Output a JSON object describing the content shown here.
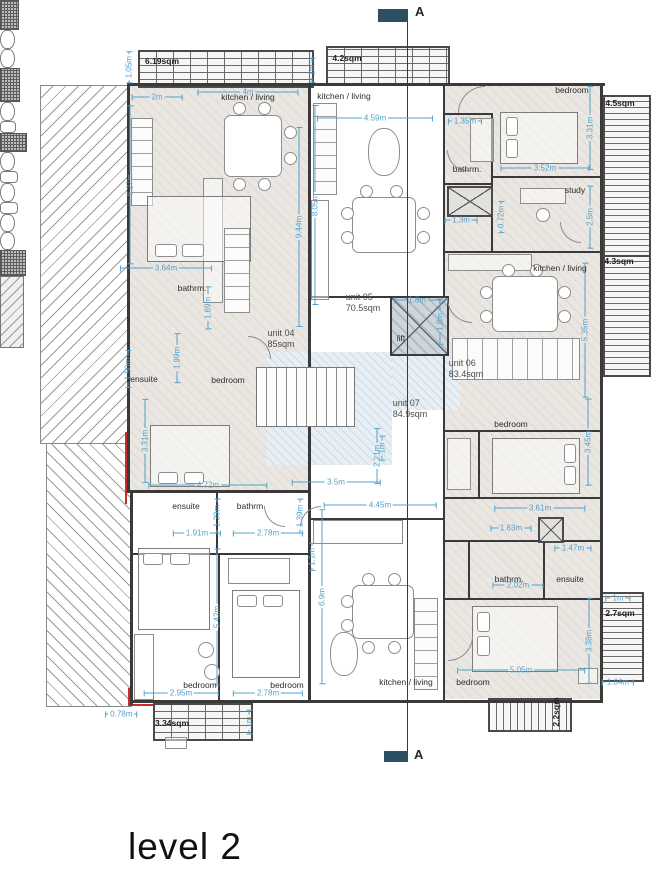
{
  "title": {
    "text": "level 2"
  },
  "section": {
    "letter_top": "A",
    "letter_bottom": "A"
  },
  "units": [
    {
      "name": "unit 04",
      "area": "85sqm",
      "x": 281,
      "y": 339
    },
    {
      "name": "unit 05",
      "area": "70.5sqm",
      "x": 363,
      "y": 303
    },
    {
      "name": "unit 06",
      "area": "83.4sqm",
      "x": 466,
      "y": 369
    },
    {
      "name": "unit 07",
      "area": "84.9sqm",
      "x": 410,
      "y": 409
    }
  ],
  "rooms": [
    {
      "t": "kitchen / living",
      "x": 248,
      "y": 97
    },
    {
      "t": "kitchen / living",
      "x": 344,
      "y": 96
    },
    {
      "t": "bathrm.",
      "x": 467,
      "y": 169
    },
    {
      "t": "bedroom",
      "x": 572,
      "y": 90
    },
    {
      "t": "study",
      "x": 575,
      "y": 190
    },
    {
      "t": "bathrm.",
      "x": 192,
      "y": 288
    },
    {
      "t": "ensuite",
      "x": 144,
      "y": 379
    },
    {
      "t": "bedroom",
      "x": 228,
      "y": 380
    },
    {
      "t": "kitchen / living",
      "x": 560,
      "y": 268
    },
    {
      "t": "bedroom",
      "x": 511,
      "y": 424
    },
    {
      "t": "lift",
      "x": 401,
      "y": 338
    },
    {
      "t": "ensuite",
      "x": 186,
      "y": 506
    },
    {
      "t": "bathrm",
      "x": 250,
      "y": 506
    },
    {
      "t": "bedroom",
      "x": 200,
      "y": 685
    },
    {
      "t": "bedroom",
      "x": 287,
      "y": 685
    },
    {
      "t": "kitchen / living",
      "x": 406,
      "y": 682
    },
    {
      "t": "bedroom",
      "x": 473,
      "y": 682
    },
    {
      "t": "bathrm.",
      "x": 509,
      "y": 579
    },
    {
      "t": "ensuite",
      "x": 570,
      "y": 579
    }
  ],
  "balcony_labels": [
    {
      "t": "6.19sqm",
      "x": 162,
      "y": 61,
      "r": 0
    },
    {
      "t": "4.2sqm",
      "x": 347,
      "y": 58,
      "r": 0
    },
    {
      "t": "4.5sqm",
      "x": 620,
      "y": 103,
      "r": 0
    },
    {
      "t": "4.3sqm",
      "x": 619,
      "y": 261,
      "r": 0
    },
    {
      "t": "2.7sqm",
      "x": 620,
      "y": 613,
      "r": 0
    },
    {
      "t": "3.34sqm",
      "x": 172,
      "y": 723,
      "r": 0
    },
    {
      "t": "2.2sqm",
      "x": 556,
      "y": 712,
      "r": 90
    }
  ],
  "dimensions": [
    {
      "t": "2m",
      "x": 157,
      "y": 97,
      "r": 0
    },
    {
      "t": "4m",
      "x": 248,
      "y": 92,
      "r": 0
    },
    {
      "t": "1m",
      "x": 312,
      "y": 70,
      "r": 90
    },
    {
      "t": "1.05m",
      "x": 129,
      "y": 70,
      "r": 90
    },
    {
      "t": "6.27m",
      "x": 130,
      "y": 185,
      "r": 90
    },
    {
      "t": "4.59m",
      "x": 375,
      "y": 118,
      "r": 0
    },
    {
      "t": "8.05m",
      "x": 315,
      "y": 205,
      "r": 90
    },
    {
      "t": "9.44m",
      "x": 299,
      "y": 227,
      "r": 90
    },
    {
      "t": "1.35m",
      "x": 465,
      "y": 121,
      "r": 0
    },
    {
      "t": "3.52m",
      "x": 545,
      "y": 168,
      "r": 0
    },
    {
      "t": "3.31m",
      "x": 590,
      "y": 128,
      "r": 90
    },
    {
      "t": "2.5m",
      "x": 590,
      "y": 217,
      "r": 90
    },
    {
      "t": "0.72m",
      "x": 501,
      "y": 224,
      "r": 90
    },
    {
      "t": "1.3m",
      "x": 461,
      "y": 220,
      "r": 0
    },
    {
      "t": "3.64m",
      "x": 166,
      "y": 268,
      "r": 0
    },
    {
      "t": "1.69m",
      "x": 208,
      "y": 308,
      "r": 90
    },
    {
      "t": "1.50m",
      "x": 128,
      "y": 369,
      "r": 90
    },
    {
      "t": "1.99m",
      "x": 177,
      "y": 358,
      "r": 90
    },
    {
      "t": "1.8m",
      "x": 417,
      "y": 300,
      "r": 0
    },
    {
      "t": "1.8m",
      "x": 440,
      "y": 322,
      "r": 90
    },
    {
      "t": "3.31m",
      "x": 145,
      "y": 441,
      "r": 90
    },
    {
      "t": "4.72m",
      "x": 208,
      "y": 485,
      "r": 0
    },
    {
      "t": "3.5m",
      "x": 336,
      "y": 482,
      "r": 0
    },
    {
      "t": "2.21m",
      "x": 377,
      "y": 456,
      "r": 90
    },
    {
      "t": "4.45m",
      "x": 380,
      "y": 505,
      "r": 0
    },
    {
      "t": "1m",
      "x": 382,
      "y": 448,
      "r": 90
    },
    {
      "t": "1.39m",
      "x": 217,
      "y": 516,
      "r": 90
    },
    {
      "t": "1.39m",
      "x": 300,
      "y": 516,
      "r": 90
    },
    {
      "t": "1.91m",
      "x": 197,
      "y": 533,
      "r": 0
    },
    {
      "t": "2.78m",
      "x": 268,
      "y": 533,
      "r": 0
    },
    {
      "t": "1.1m",
      "x": 312,
      "y": 557,
      "r": 90
    },
    {
      "t": "5.42m",
      "x": 217,
      "y": 617,
      "r": 90
    },
    {
      "t": "6.9m",
      "x": 322,
      "y": 597,
      "r": 90
    },
    {
      "t": "2.95m",
      "x": 181,
      "y": 693,
      "r": 0
    },
    {
      "t": "2.78m",
      "x": 268,
      "y": 693,
      "r": 0
    },
    {
      "t": "5.35m",
      "x": 585,
      "y": 330,
      "r": 90
    },
    {
      "t": "3.45m",
      "x": 588,
      "y": 442,
      "r": 90
    },
    {
      "t": "3.61m",
      "x": 540,
      "y": 508,
      "r": 0
    },
    {
      "t": "1.63m",
      "x": 511,
      "y": 528,
      "r": 0
    },
    {
      "t": "1.47m",
      "x": 573,
      "y": 548,
      "r": 0
    },
    {
      "t": "2.02m",
      "x": 518,
      "y": 585,
      "r": 0
    },
    {
      "t": "1m",
      "x": 618,
      "y": 598,
      "r": 0
    },
    {
      "t": "3.38m",
      "x": 589,
      "y": 641,
      "r": 90
    },
    {
      "t": "5.05m",
      "x": 521,
      "y": 670,
      "r": 0
    },
    {
      "t": "1.04m",
      "x": 615,
      "y": 682,
      "r": 0
    },
    {
      "t": "0.78m",
      "x": 115,
      "y": 714,
      "r": 0
    },
    {
      "t": "1m",
      "x": 249,
      "y": 722,
      "r": 90
    }
  ],
  "colors": {
    "dimension_text": "#54a1cc",
    "wall": "#3a3a3a",
    "unit_fill": "#eae6e1",
    "section_flag": "#2d4f63",
    "red_line": "#cc2a2a"
  }
}
